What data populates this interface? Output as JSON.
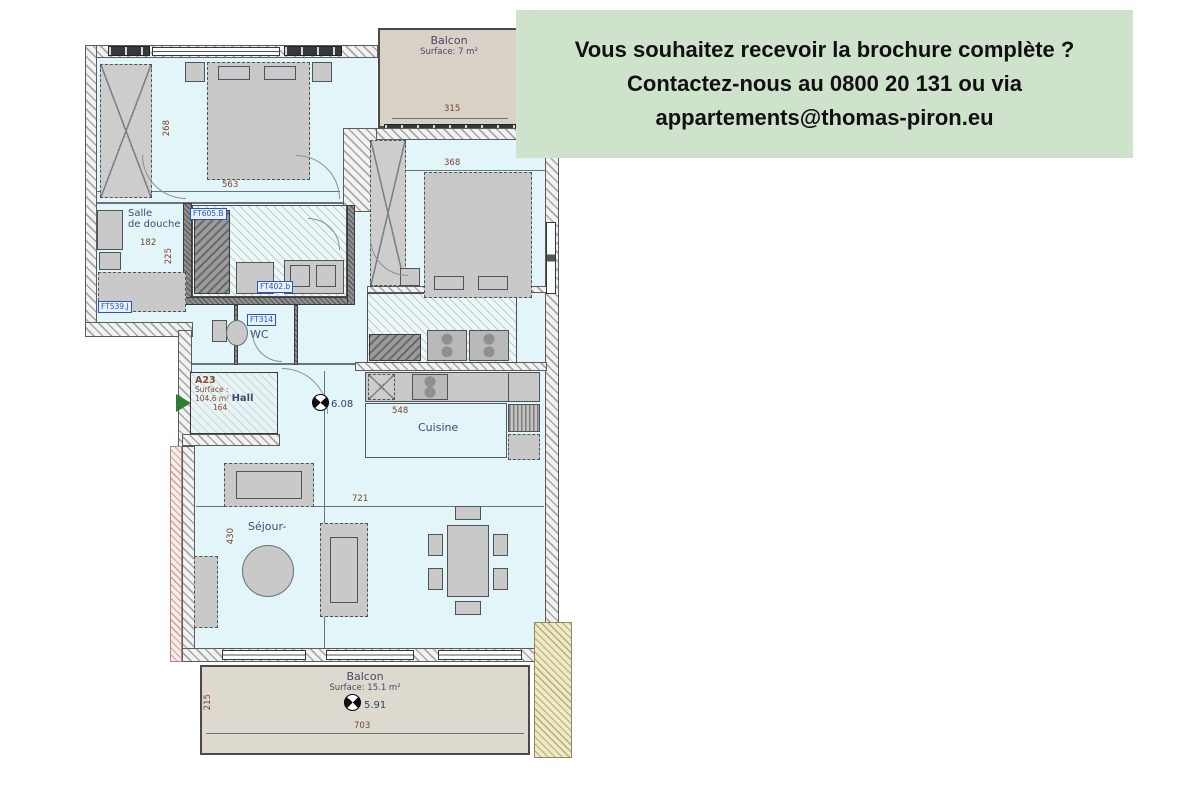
{
  "banner": {
    "line1": "Vous souhaitez recevoir la brochure complète ?",
    "line2": "Contactez-nous au 0800 20 131 ou via",
    "line3": "appartements@thomas-piron.eu",
    "bg_color": "#cfe2cc",
    "text_color": "#111111"
  },
  "plan": {
    "unit": {
      "code": "A23",
      "surface_label": "Surface :",
      "surface_value": "104.6 m²",
      "room": "Hall",
      "dim": "164",
      "north_value": "6.08"
    },
    "balcon_top": {
      "name": "Balcon",
      "surface": "Surface: 7 m²",
      "dim_w": "315"
    },
    "chambre1": {
      "name": "Chambre 1",
      "dim_w": "563",
      "dim_h": "268"
    },
    "chambre2": {
      "name": "Chambre 2",
      "dim_w": "368",
      "dim_h": "245"
    },
    "salle_de_douche": {
      "name_line1": "Salle",
      "name_line2": "de douche",
      "dim_w": "182",
      "dim_h": "225"
    },
    "salle_de_bain": {
      "name": "Salle de bain",
      "dim_w": "245",
      "dim_r": "115"
    },
    "wc": {
      "name": "WC",
      "dim_w": "145",
      "dim_r": "176"
    },
    "loc_tech": {
      "name": "Loc. Tech.",
      "dim_w": "302",
      "dim_h": "139"
    },
    "cuisine": {
      "name": "Cuisine",
      "dim_w": "548"
    },
    "sejour": {
      "name": "Séjour-",
      "dim_w": "721",
      "dim_h": "430"
    },
    "balcon_bottom": {
      "name": "Balcon",
      "surface": "Surface: 15.1 m²",
      "dim_w": "703",
      "dim_h": "215",
      "north_value": "5.91"
    },
    "ft_labels": {
      "bain_top": "FT605.B",
      "douche": "FT539.J",
      "bain_bottom": "FT402.b",
      "wc": "FT314"
    },
    "colors": {
      "floor": "#e2f5f8",
      "balcony_floor": "#d8d2c6",
      "dimension_text": "#7c3f2c",
      "room_label_text": "#3e4d6e",
      "ft_label_text": "#2456c4",
      "entrance_arrow": "#2e7d32"
    }
  }
}
